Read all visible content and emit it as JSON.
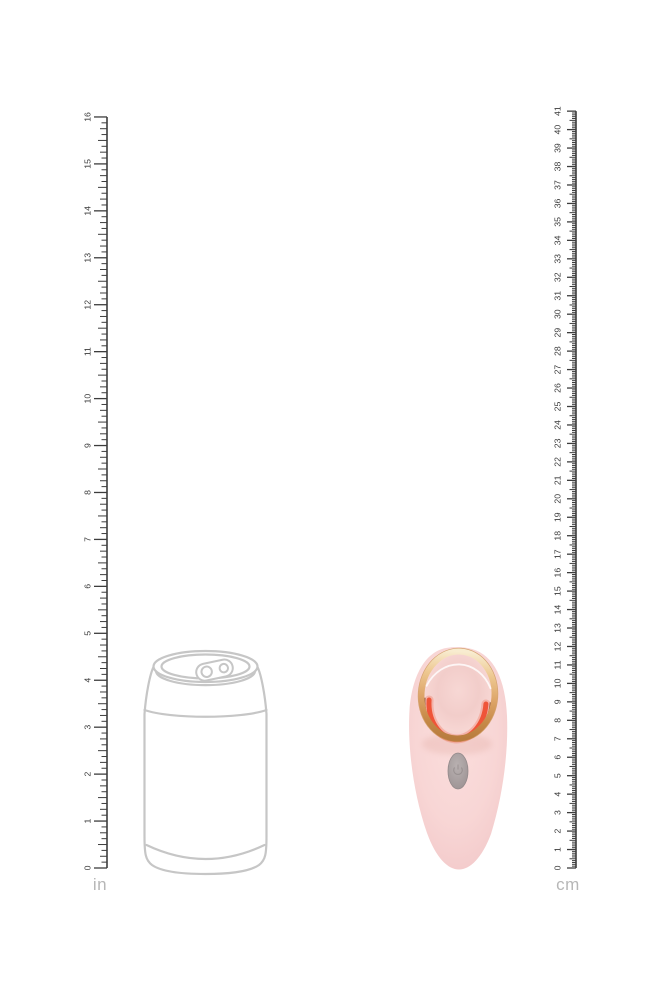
{
  "page": {
    "background": "#ffffff"
  },
  "rulers": {
    "left": {
      "name": "ruler-inches",
      "unit_label": "in",
      "max": 16,
      "labels": [
        "0",
        "1",
        "2",
        "3",
        "4",
        "5",
        "6",
        "7",
        "8",
        "9",
        "10",
        "11",
        "12",
        "13",
        "14",
        "15",
        "16"
      ]
    },
    "right": {
      "name": "ruler-centimeters",
      "unit_label": "cm",
      "max": 41,
      "labels": [
        "0",
        "1",
        "2",
        "3",
        "4",
        "5",
        "6",
        "7",
        "8",
        "9",
        "10",
        "11",
        "12",
        "13",
        "14",
        "15",
        "16",
        "17",
        "18",
        "19",
        "20",
        "21",
        "22",
        "23",
        "24",
        "25",
        "26",
        "27",
        "28",
        "29",
        "30",
        "31",
        "32",
        "33",
        "34",
        "35",
        "36",
        "37",
        "38",
        "39",
        "40",
        "41"
      ]
    }
  },
  "figures": {
    "can": {
      "name": "beverage-can-outline"
    },
    "product": {
      "name": "pink-rose-gold-massager"
    }
  },
  "colors": {
    "page_bg": "#ffffff",
    "ruler_line": "#3d3d3d",
    "ruler_text": "#3a3a3a",
    "unit_text": "#b7b7b7",
    "can_outline": "#c6c6c6",
    "product_body": "#f8d6d5",
    "product_body_edge": "#f1c6c7",
    "ring_gold": "#dca367",
    "ring_gold_light": "#f8ecd0",
    "ring_gold_dark": "#b87c3e",
    "accent_coral": "#ee4f31",
    "bronze_line": "#713f20",
    "face_pink": "#f5d2cf",
    "button_gray": "#a29a9a"
  }
}
